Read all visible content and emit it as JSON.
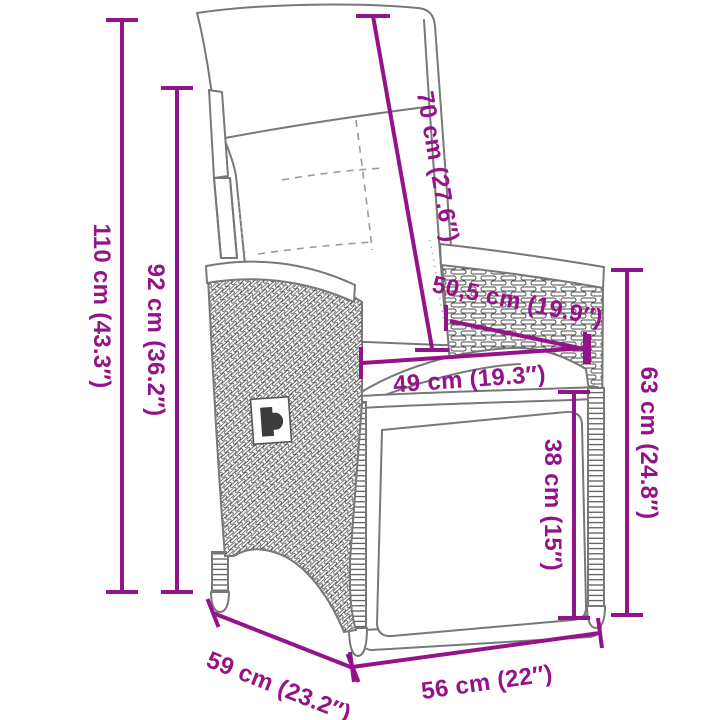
{
  "diagram": {
    "subject": "reclining poly-rattan garden chair with back cushion and fold-up footrest",
    "style": "black-and-white line-art product dimension drawing with magenta measurements",
    "colors": {
      "dimension_annotation": "#951388",
      "line_art": "#787878",
      "weave_texture": "#4d4d4d",
      "background": "#ffffff"
    },
    "dimensions": [
      {
        "id": "total-height",
        "label": "110 cm (43.3″)",
        "cm": 110,
        "inches": 43.3
      },
      {
        "id": "backrest-height",
        "label": "92 cm (36.2″)",
        "cm": 92,
        "inches": 36.2
      },
      {
        "id": "back-cushion-length",
        "label": "70 cm (27.6″)",
        "cm": 70,
        "inches": 27.6
      },
      {
        "id": "armrest-length",
        "label": "50,5 cm (19.9″)",
        "cm": 50.5,
        "inches": 19.9
      },
      {
        "id": "seat-depth",
        "label": "49 cm (19.3″)",
        "cm": 49,
        "inches": 19.3
      },
      {
        "id": "side-panel-height",
        "label": "63 cm (24.8″)",
        "cm": 63,
        "inches": 24.8
      },
      {
        "id": "footrest-height",
        "label": "38 cm (15″)",
        "cm": 38,
        "inches": 15
      },
      {
        "id": "base-depth",
        "label": "59 cm (23.2″)",
        "cm": 59,
        "inches": 23.2
      },
      {
        "id": "base-width",
        "label": "56 cm (22″)",
        "cm": 56,
        "inches": 22
      }
    ]
  }
}
